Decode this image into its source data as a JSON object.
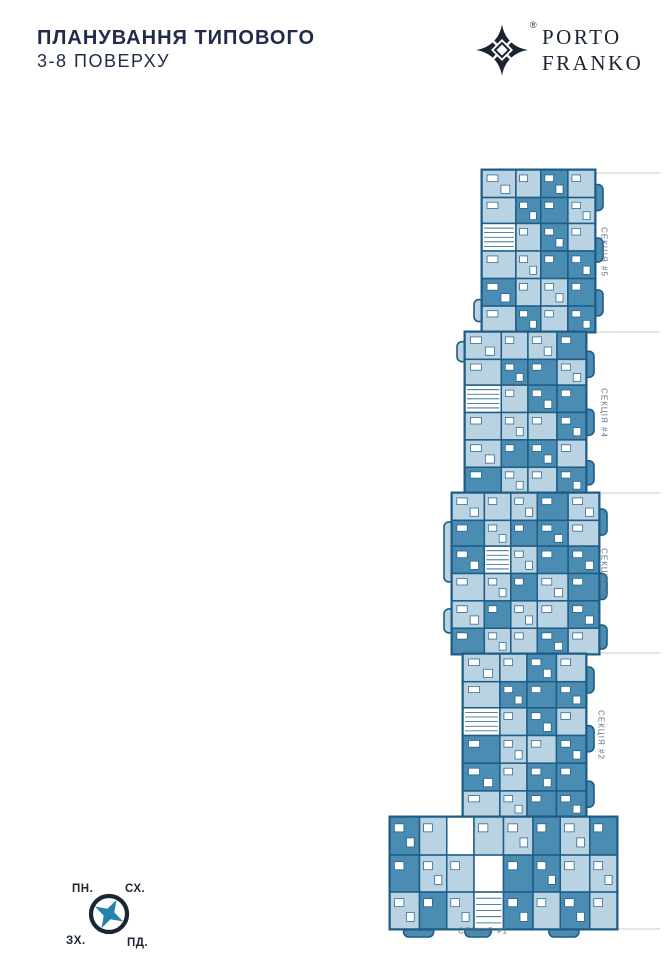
{
  "header": {
    "title_line1": "ПЛАНУВАННЯ ТИПОВОГО",
    "title_line2": "3-8 ПОВЕРХУ"
  },
  "logo": {
    "registered_mark": "®",
    "brand_line1": "PORTO",
    "brand_line2": "FRANKO"
  },
  "plan": {
    "colors": {
      "light": "#b9d3e3",
      "mid": "#4b8cb2",
      "wall": "#1e5d86",
      "white": "#ffffff",
      "label": "#5f7380",
      "tick": "#c8cbcf"
    },
    "sections": [
      {
        "id": "section-5",
        "label": "СЕКЦІЯ #5",
        "x": 482,
        "y": 170,
        "w": 113,
        "h": 162,
        "orientation": "vertical",
        "label_x": 604,
        "label_y": 252,
        "cols": [
          0,
          0.3,
          0.52,
          0.76,
          1
        ],
        "rows": [
          0,
          0.17,
          0.33,
          0.5,
          0.67,
          0.84,
          1
        ],
        "cells": [
          "LLML",
          "LMML",
          "SLML",
          "LLMM",
          "MLLM",
          "LMLM"
        ],
        "balconies": [
          {
            "side": "right",
            "t": 0.09,
            "len": 26
          },
          {
            "side": "right",
            "t": 0.42,
            "len": 24
          },
          {
            "side": "right",
            "t": 0.74,
            "len": 26
          },
          {
            "side": "left",
            "t": 0.8,
            "len": 22
          }
        ]
      },
      {
        "id": "section-4",
        "label": "СЕКЦІЯ #4",
        "x": 465,
        "y": 332,
        "w": 121,
        "h": 161,
        "orientation": "vertical",
        "label_x": 604,
        "label_y": 413,
        "cols": [
          0,
          0.3,
          0.52,
          0.76,
          1
        ],
        "rows": [
          0,
          0.17,
          0.33,
          0.5,
          0.67,
          0.84,
          1
        ],
        "cells": [
          "LLLM",
          "LMML",
          "SLMM",
          "LLLM",
          "LMML",
          "MLLM"
        ],
        "balconies": [
          {
            "side": "right",
            "t": 0.12,
            "len": 26
          },
          {
            "side": "right",
            "t": 0.48,
            "len": 26
          },
          {
            "side": "right",
            "t": 0.8,
            "len": 24
          },
          {
            "side": "left",
            "t": 0.06,
            "len": 20
          }
        ]
      },
      {
        "id": "section-3",
        "label": "СЕКЦІЯ #3",
        "x": 452,
        "y": 493,
        "w": 147,
        "h": 161,
        "orientation": "vertical",
        "label_x": 604,
        "label_y": 573,
        "cols": [
          0,
          0.22,
          0.4,
          0.58,
          0.79,
          1
        ],
        "rows": [
          0,
          0.17,
          0.33,
          0.5,
          0.67,
          0.84,
          1
        ],
        "cells": [
          "LLLML",
          "MLMML",
          "MSLMM",
          "LLMLM",
          "LMLLM",
          "MLLML"
        ],
        "balconies": [
          {
            "side": "right",
            "t": 0.1,
            "len": 26
          },
          {
            "side": "right",
            "t": 0.5,
            "len": 26
          },
          {
            "side": "right",
            "t": 0.82,
            "len": 24
          },
          {
            "side": "left",
            "t": 0.18,
            "len": 60
          },
          {
            "side": "left",
            "t": 0.72,
            "len": 24
          }
        ]
      },
      {
        "id": "section-2",
        "label": "СЕКЦІЯ #2",
        "x": 463,
        "y": 654,
        "w": 123,
        "h": 163,
        "orientation": "vertical",
        "label_x": 601,
        "label_y": 735,
        "cols": [
          0,
          0.3,
          0.52,
          0.76,
          1
        ],
        "rows": [
          0,
          0.17,
          0.33,
          0.5,
          0.67,
          0.84,
          1
        ],
        "cells": [
          "LLML",
          "LMMM",
          "SLML",
          "MLLM",
          "MLMM",
          "LLMM"
        ],
        "balconies": [
          {
            "side": "right",
            "t": 0.08,
            "len": 26
          },
          {
            "side": "right",
            "t": 0.44,
            "len": 26
          },
          {
            "side": "right",
            "t": 0.78,
            "len": 26
          }
        ]
      },
      {
        "id": "section-1",
        "label": "СЕКЦІЯ #1",
        "x": 390,
        "y": 817,
        "w": 227,
        "h": 112,
        "orientation": "horizontal",
        "label_x": 483,
        "label_y": 931,
        "cols": [
          0,
          0.13,
          0.25,
          0.37,
          0.5,
          0.63,
          0.75,
          0.88,
          1
        ],
        "rows": [
          0,
          0.34,
          0.67,
          1
        ],
        "cells": [
          "MLWLLMLM",
          "MLLWMMLL",
          "LMLSMLML"
        ],
        "balconies": [
          {
            "side": "bottom",
            "t": 0.06,
            "len": 30
          },
          {
            "side": "bottom",
            "t": 0.33,
            "len": 26
          },
          {
            "side": "bottom",
            "t": 0.7,
            "len": 30
          }
        ]
      }
    ],
    "ticks": [
      {
        "x1": 588,
        "y1": 173,
        "x2": 660,
        "y2": 173
      },
      {
        "x1": 588,
        "y1": 332,
        "x2": 660,
        "y2": 332
      },
      {
        "x1": 590,
        "y1": 493,
        "x2": 660,
        "y2": 493
      },
      {
        "x1": 590,
        "y1": 653,
        "x2": 660,
        "y2": 653
      },
      {
        "x1": 570,
        "y1": 817,
        "x2": 607,
        "y2": 817
      },
      {
        "x1": 563,
        "y1": 903,
        "x2": 563,
        "y2": 930
      },
      {
        "x1": 566,
        "y1": 929,
        "x2": 660,
        "y2": 929
      }
    ]
  },
  "compass": {
    "labels": {
      "top_left": "ПН.",
      "top_right": "СХ.",
      "bottom_left": "ЗХ.",
      "bottom_right": "ПД."
    },
    "ring_color": "#1c2633",
    "star_color": "#2383ab"
  }
}
